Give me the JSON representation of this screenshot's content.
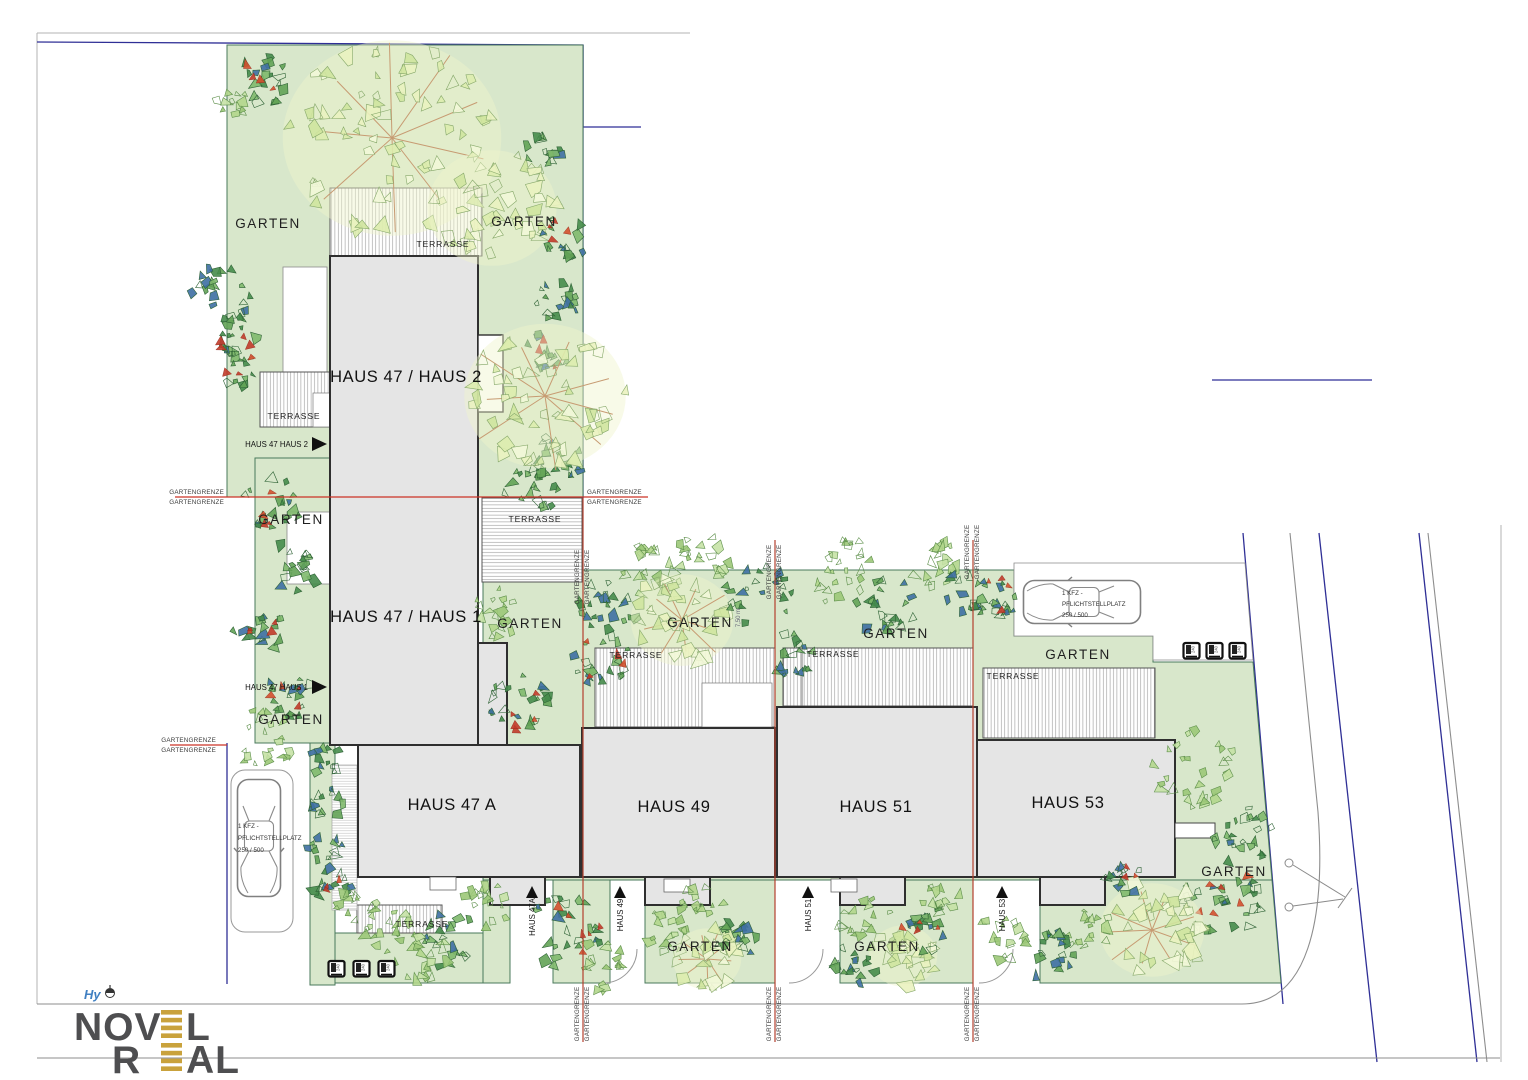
{
  "labels": {
    "garten": "GARTEN",
    "terrasse": "TERRASSE",
    "gartengrenze": "GARTENGRENZE",
    "dimension": "7,50 m"
  },
  "buildings": {
    "haus_47_2": "HAUS 47 / HAUS 2",
    "haus_47_1": "HAUS 47 / HAUS 1",
    "haus_47a": "HAUS 47 A",
    "haus_49": "HAUS 49",
    "haus_51": "HAUS 51",
    "haus_53": "HAUS 53"
  },
  "entrances": {
    "haus_47_2": "HAUS 47 HAUS 2",
    "haus_47_1": "HAUS 47 HAUS 1",
    "haus_47a": "HAUS 47A",
    "haus_49": "HAUS 49",
    "haus_51": "HAUS 51",
    "haus_53": "HAUS 53"
  },
  "parking": {
    "line1": "1 KFZ -",
    "line2": "PFLICHTSTELLPLATZ",
    "line3": "250 / 500"
  },
  "bins": {
    "size": "240"
  },
  "hydrant": {
    "label": "Hy"
  },
  "logo": {
    "word1": "NOVEL",
    "word2": "REAL",
    "part1a": "NOV",
    "part1b": "L",
    "part2a": "R",
    "part2b": "AL"
  },
  "colors": {
    "garden_green": "#d8e7cb",
    "garden_edge": "#49795b",
    "building_gray": "#e5e5e5",
    "building_edge": "#2f2f2f",
    "boundary_blue": "#2f2f96",
    "grenze_red": "#cc3326",
    "logo_gold": "#c9a23c",
    "logo_gray": "#4e4e50",
    "hy_blue": "#3f7fc1"
  }
}
